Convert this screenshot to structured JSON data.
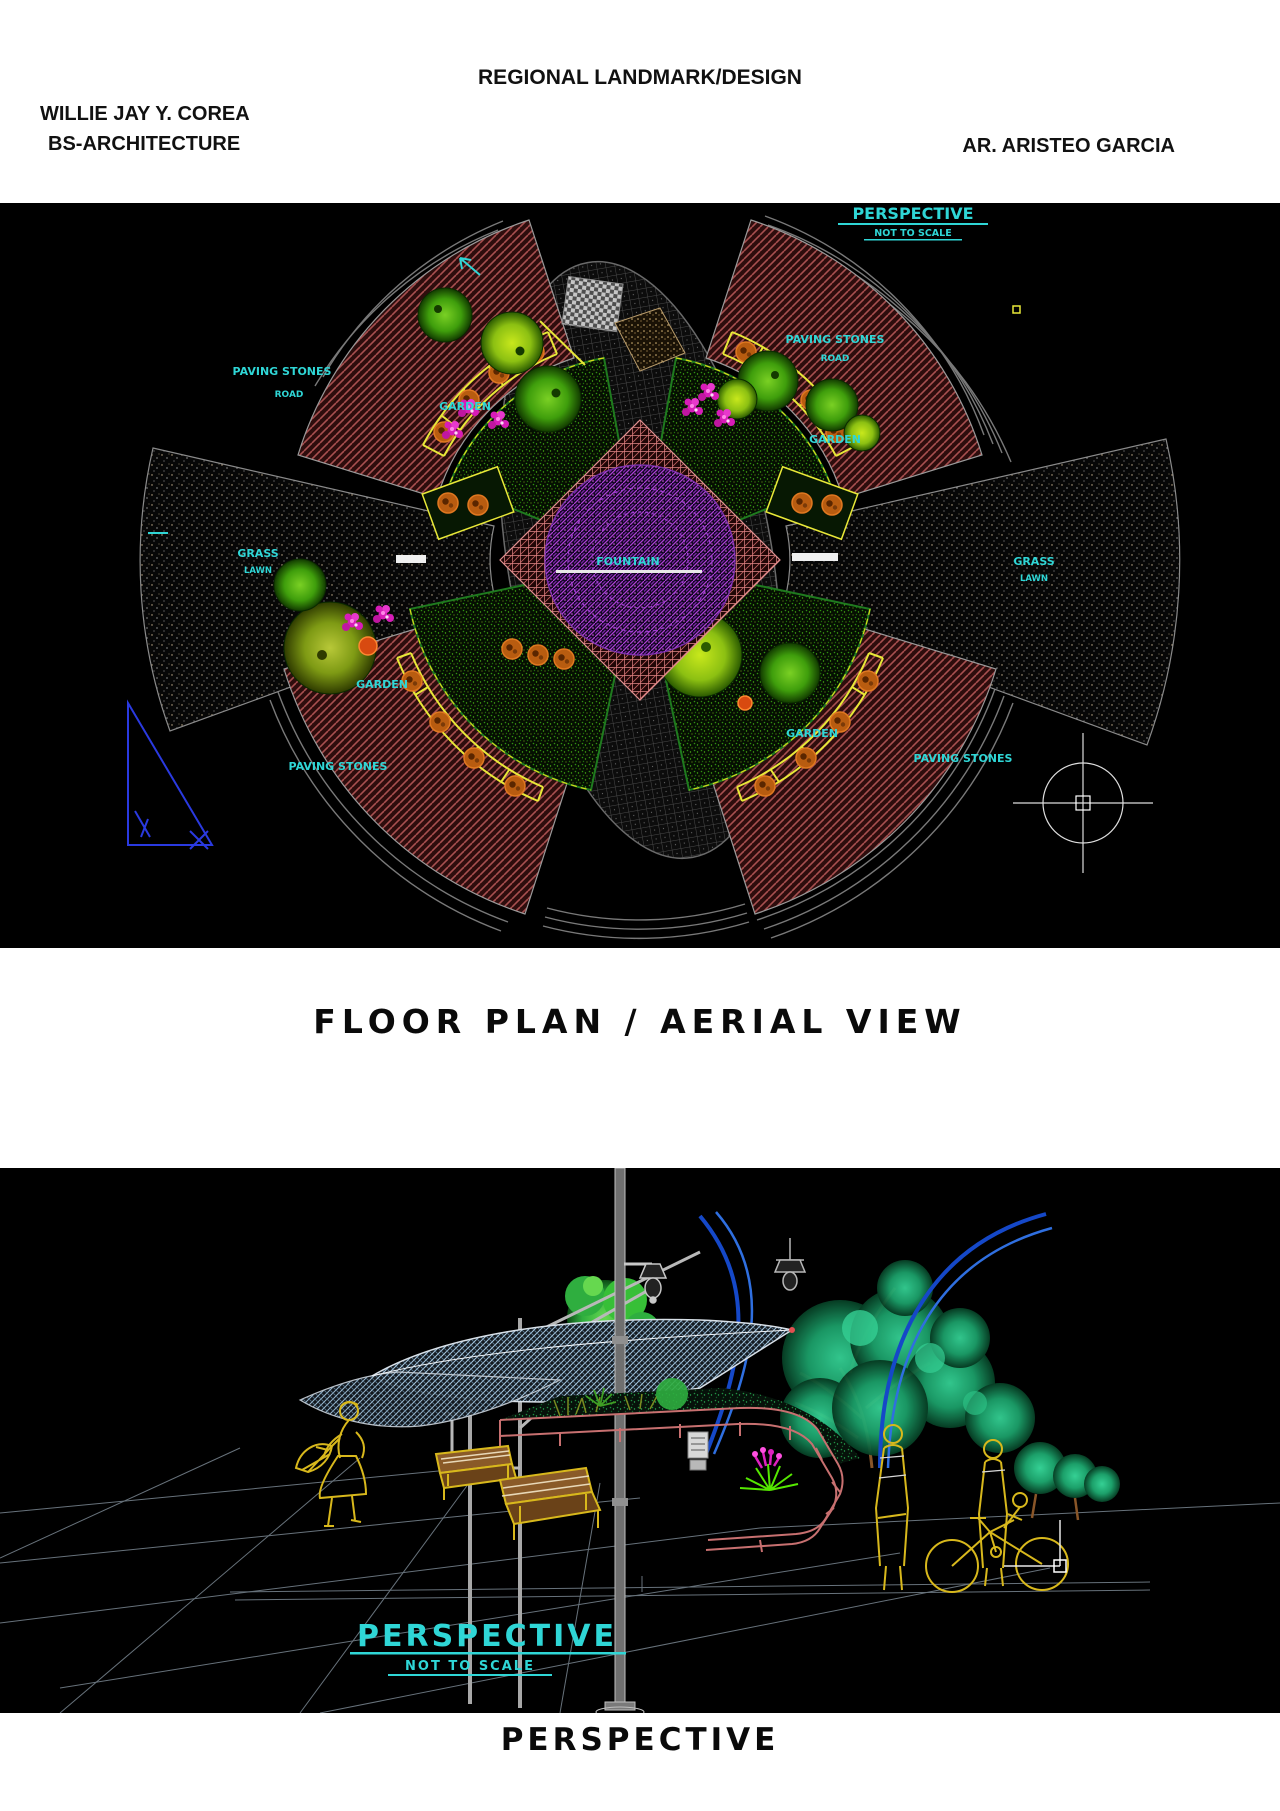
{
  "header": {
    "title": "REGIONAL LANDMARK/DESIGN",
    "student_name": "WILLIE JAY Y. COREA",
    "course": "BS-ARCHITECTURE",
    "instructor": "AR. ARISTEO GARCIA"
  },
  "floor_plan": {
    "corner_label": "PERSPECTIVE",
    "corner_sublabel": "NOT TO SCALE",
    "caption": "FLOOR PLAN / AERIAL VIEW",
    "labels": {
      "paving_nw": "PAVING STONES",
      "paving_nw_sub": "ROAD",
      "paving_ne": "PAVING STONES",
      "paving_ne_sub": "ROAD",
      "paving_sw": "PAVING STONES",
      "paving_se": "PAVING STONES",
      "garden_nw": "GARDEN",
      "garden_ne": "GARDEN",
      "garden_sw": "GARDEN",
      "garden_se": "GARDEN",
      "grass_w": "GRASS",
      "grass_w_sub": "LAWN",
      "grass_e": "GRASS",
      "grass_e_sub": "LAWN",
      "center": "FOUNTAIN"
    }
  },
  "perspective": {
    "label": "PERSPECTIVE",
    "sublabel": "NOT TO SCALE",
    "caption": "PERSPECTIVE"
  },
  "colors": {
    "cad_cyan": "#2fd6d6",
    "cad_yellow": "#e8e838",
    "bench_orange": "#c06010",
    "paving_red": "#a85050",
    "blue_arc": "#1e5ad0",
    "drawing_bg": "#000000"
  }
}
